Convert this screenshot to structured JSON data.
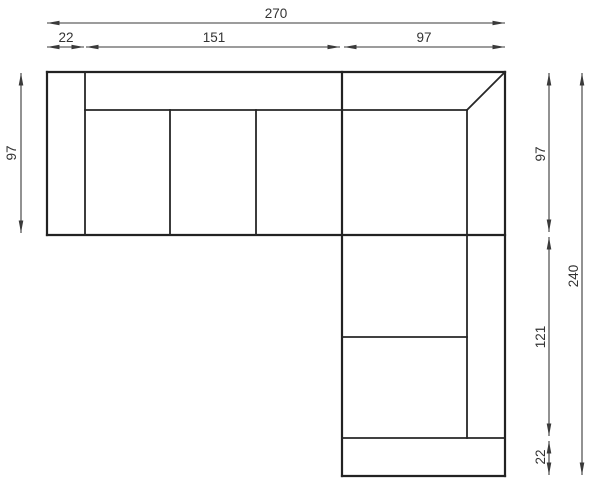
{
  "diagram": {
    "type": "corner-sofa-top-view-dimension-drawing",
    "units": "cm",
    "background_color": "#ffffff",
    "sofa_line_color": "#222222",
    "dimension_line_color": "#3a3a3a",
    "text_color": "#333333",
    "dims": {
      "top_total": "270",
      "top_armrest": "22",
      "top_seats": "151",
      "top_corner": "97",
      "left_depth": "97",
      "right_upper": "97",
      "right_chaise": "121",
      "right_armrest": "22",
      "right_total": "240"
    },
    "measurements_cm": {
      "overall_width": 270,
      "overall_depth": 240,
      "left_armrest_width": 22,
      "straight_seat_width": 151,
      "corner_section_width": 97,
      "sofa_depth": 97,
      "chaise_length": 121,
      "bottom_armrest_width": 22
    }
  }
}
